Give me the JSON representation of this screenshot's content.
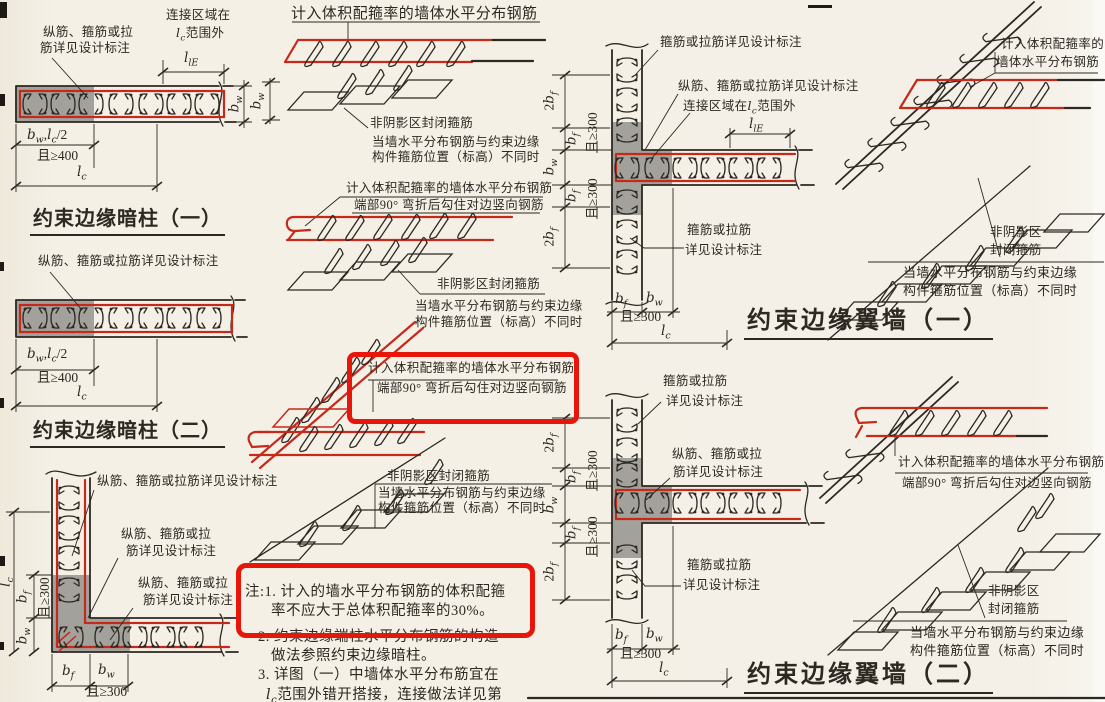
{
  "colors": {
    "paper": "#f4f0e7",
    "ink": "#2c2822",
    "red": "#c6281a",
    "hl": "#e8150a",
    "shade": "#a3a19b"
  },
  "labels": {
    "rebar_note": "纵筋、箍筋或拉筋详见设计标注",
    "rebar_note_l1": "纵筋、箍筋或拉",
    "rebar_note_l2": "筋详见设计标注",
    "stirrup_note": "箍筋或拉筋详见设计标注",
    "stirrup_note_l1": "箍筋或拉筋",
    "stirrup_note_l2": "详见设计标注",
    "connect_full": "连接区域在l_{c}范围外",
    "connect_l1": "连接区域在",
    "connect_l2": "l_{c}范围外",
    "vol_note": "计入体积配箍率的墙体水平分布钢筋",
    "vol_note_l1": "计入体积配箍率的",
    "vol_note_l2": "墙体水平分布钢筋",
    "hook_note": "端部90° 弯折后勾住对边竖向钢筋",
    "nonshade_note": "非阴影区封闭箍筋",
    "nonshade_l1": "非阴影区",
    "nonshade_l2": "封闭箍筋",
    "when_l1": "当墙水平分布钢筋与约束边缘",
    "when_l2": "构件箍筋位置（标高）不同时"
  },
  "dims": {
    "bw_lc2": "b_{w},l_{c}/2",
    "ge400": "且≥400",
    "ge300": "且≥300",
    "lc": "l_{c}",
    "bw": "b_{w}",
    "bf": "b_{f}",
    "bf2": "2b_{f}",
    "lle": "l_{lE}"
  },
  "titles": {
    "t1": "约束边缘暗柱（一）",
    "t2": "约束边缘暗柱（二）",
    "t3": "约束边缘翼墙（一）",
    "t4": "约束边缘翼墙（二）"
  },
  "notes": {
    "l1a": "注:1. 计入的墙水平分布钢筋的体积配箍",
    "l1b": "率不应大于总体积配箍率的30%。",
    "l2a": "2. 约束边缘端柱水平分布钢筋的构造",
    "l2b": "做法参照约束边缘暗柱。",
    "l3a": "3. 详图（一）中墙体水平分布筋宜在",
    "l3b": "l_{c}范围外错开搭接，连接做法详见第"
  }
}
